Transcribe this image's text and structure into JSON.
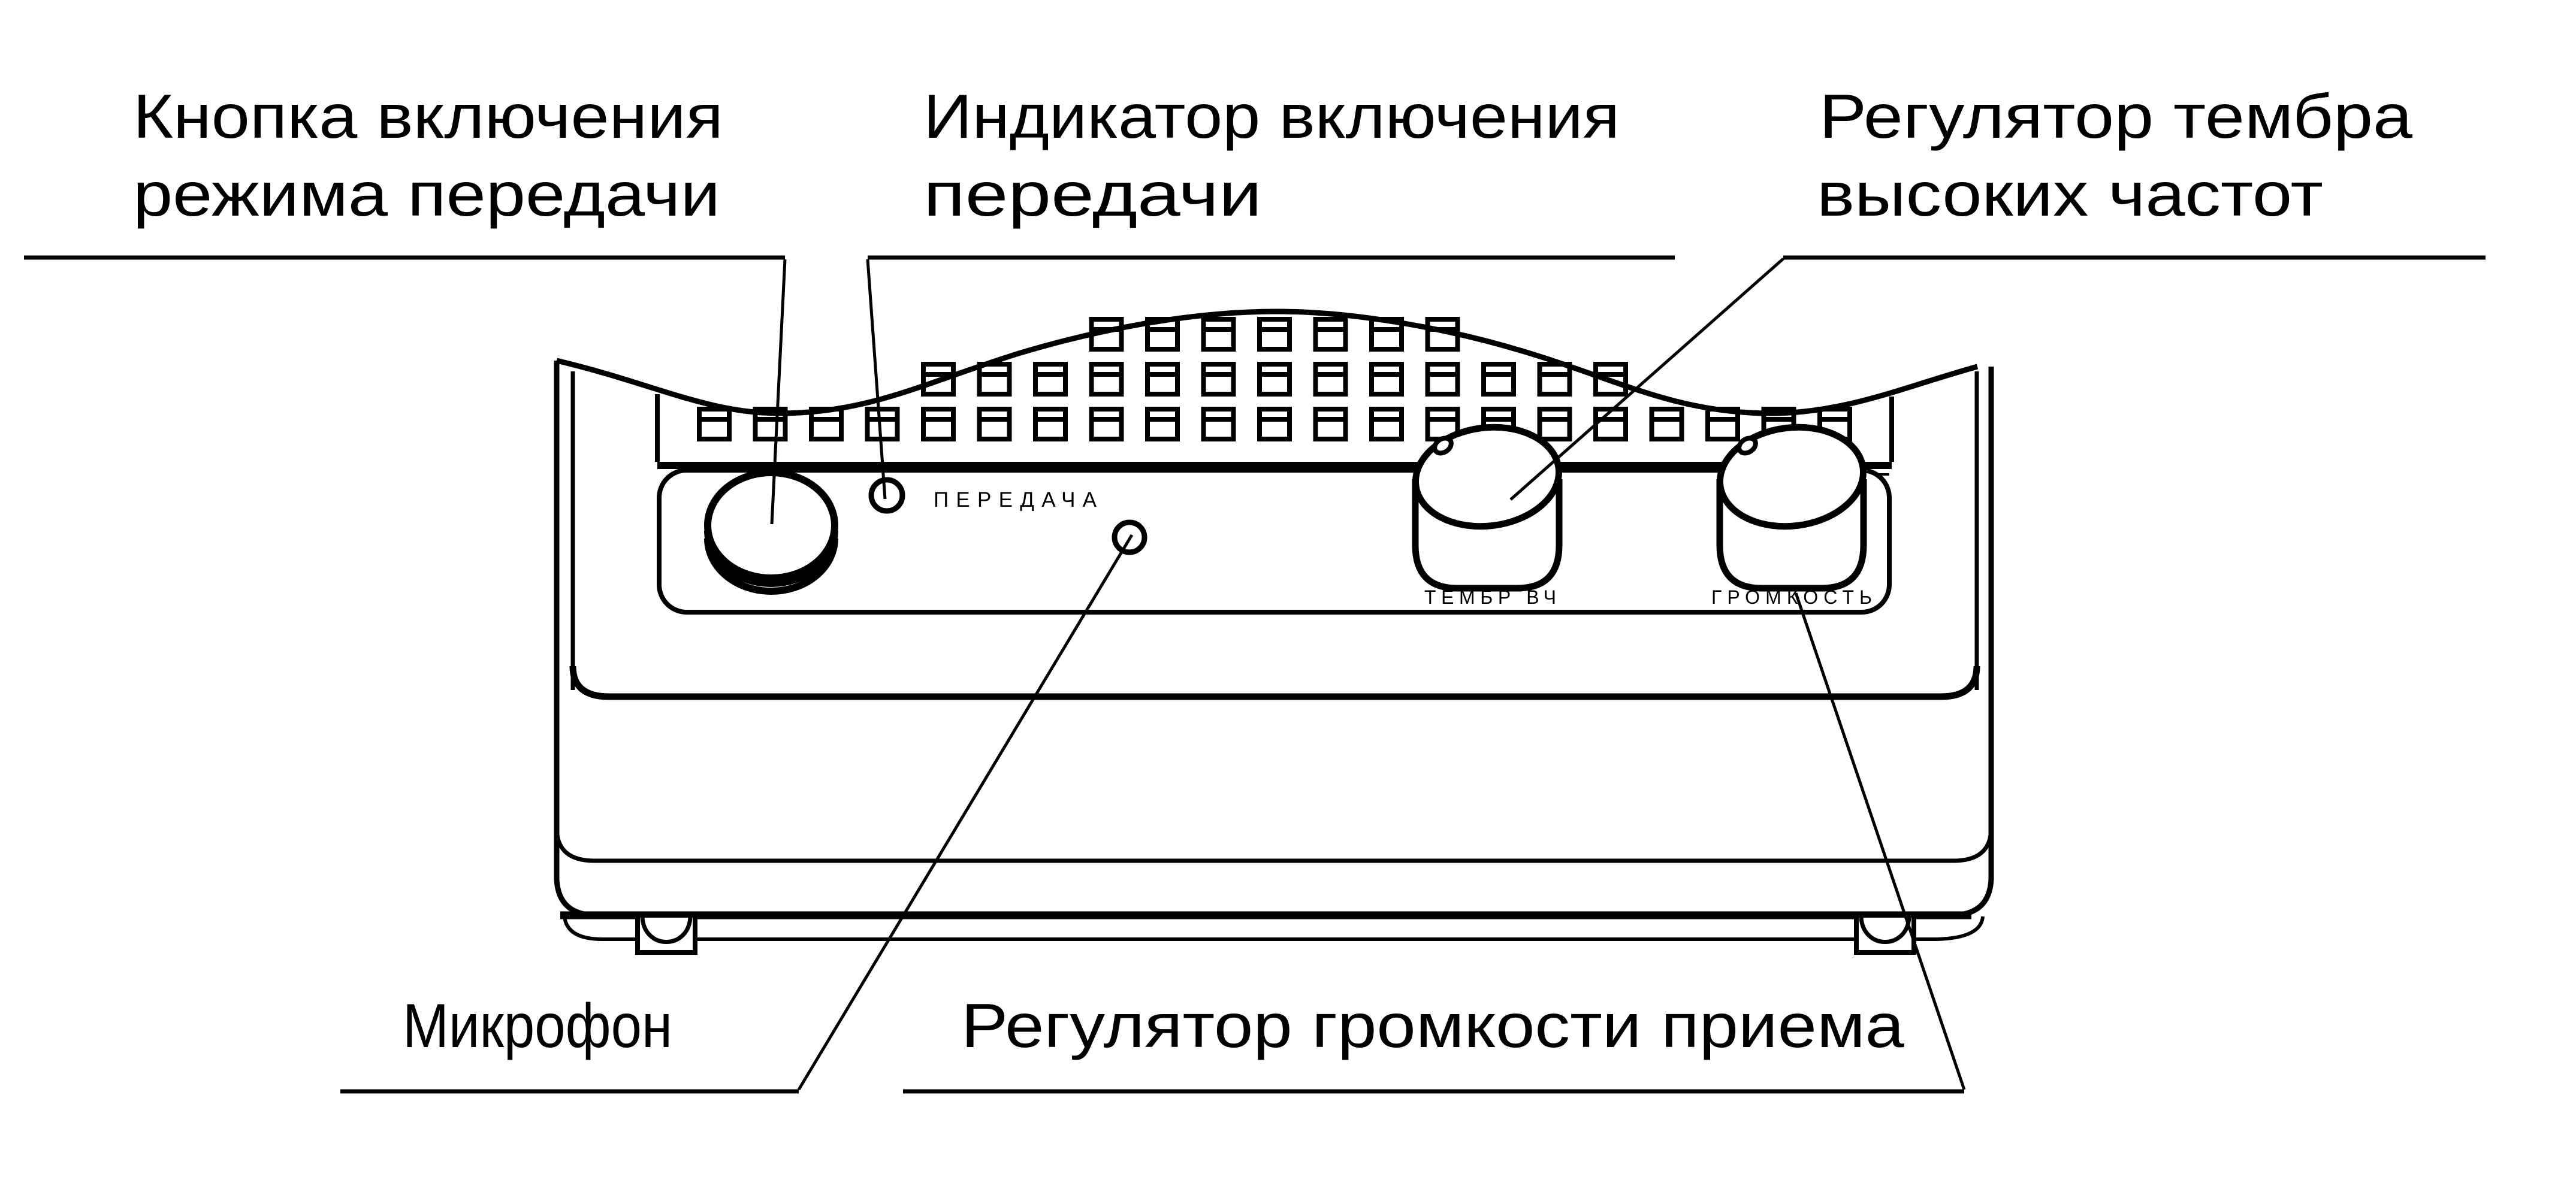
{
  "figure": {
    "type": "technical-line-diagram",
    "subject": "intercom-speaker-unit-front-view",
    "colors": {
      "ink": "#000000",
      "paper": "#ffffff"
    }
  },
  "callouts": {
    "transmit_button": {
      "line1": "Кнопка включения",
      "line2": "режима передачи"
    },
    "transmit_indicator": {
      "line1": "Индикатор включения",
      "line2": "передачи"
    },
    "treble_control": {
      "line1": "Регулятор тембра",
      "line2": "высоких частот"
    },
    "microphone": {
      "line1": "Микрофон"
    },
    "volume_control": {
      "line1": "Регулятор громкости приема"
    }
  },
  "panel": {
    "indicator_label": "ПЕРЕДАЧА",
    "treble_knob_label": "ТЕМБР ВЧ",
    "volume_knob_label": "ГРОМКОСТЬ"
  }
}
